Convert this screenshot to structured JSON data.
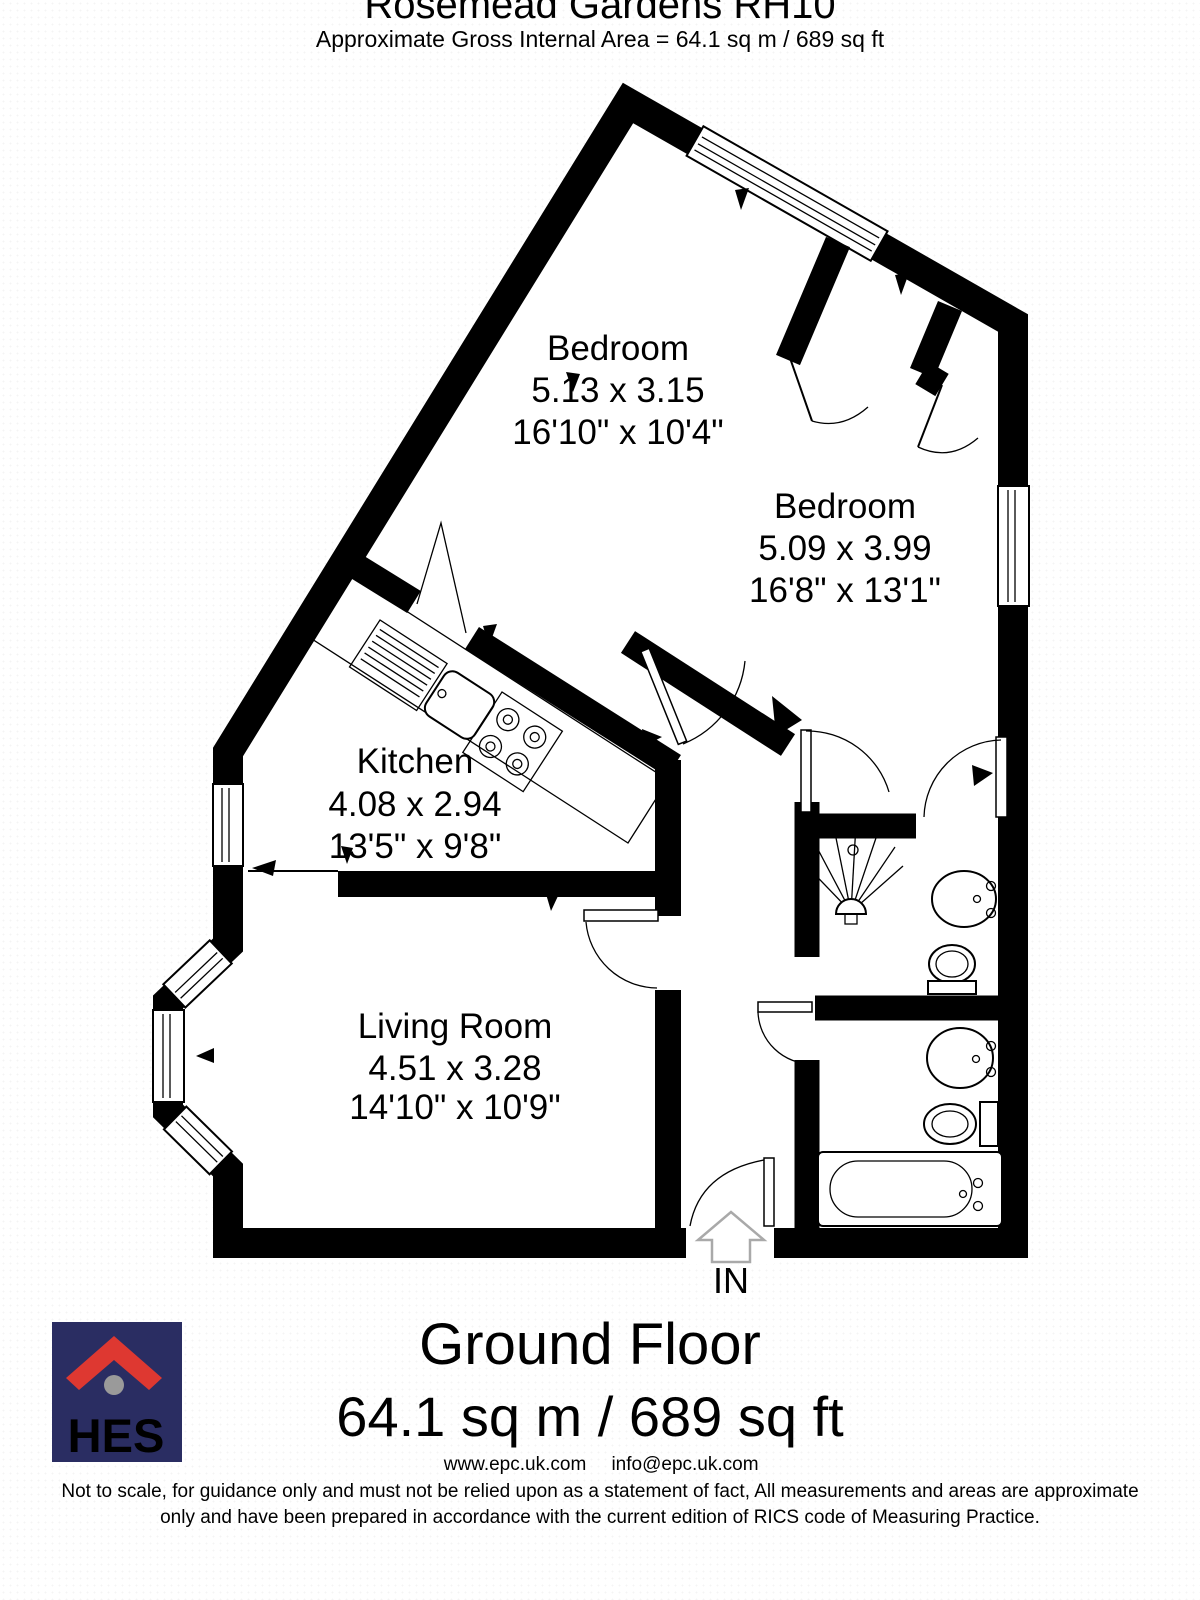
{
  "header": {
    "title": "Rosemead Gardens RH10",
    "subtitle": "Approximate Gross Internal Area = 64.1 sq m / 689 sq ft"
  },
  "rooms": [
    {
      "name": "Bedroom",
      "metric": "5.13 x 3.15",
      "imperial": "16'10\" x 10'4\""
    },
    {
      "name": "Bedroom",
      "metric": "5.09 x 3.99",
      "imperial": "16'8\" x 13'1\""
    },
    {
      "name": "Kitchen",
      "metric": "4.08 x 2.94",
      "imperial": "13'5\" x 9'8\""
    },
    {
      "name": "Living Room",
      "metric": "4.51 x 3.28",
      "imperial": "14'10\" x 10'9\""
    }
  ],
  "entrance": {
    "label": "IN"
  },
  "floor": {
    "name": "Ground Floor",
    "area": "64.1 sq m / 689 sq ft"
  },
  "logo": {
    "text": "HES",
    "square_color": "#2a2d62",
    "roof_color": "#de3831",
    "dot_color": "#9a9a9a"
  },
  "footer": {
    "website": "www.epc.uk.com",
    "email": "info@epc.uk.com",
    "disclaimer_line1": "Not to scale, for guidance only and must not be relied upon as a statement of fact, All measurements and areas are approximate",
    "disclaimer_line2": "only and have been prepared in accordance with the current edition of RICS code of Measuring Practice."
  },
  "plan": {
    "wall_color": "#000000",
    "fixtures": [
      "bay-window",
      "window",
      "kitchen-sink",
      "hob",
      "shower",
      "toilet",
      "sink",
      "bathtub",
      "door-swing",
      "entrance-arrow"
    ]
  }
}
